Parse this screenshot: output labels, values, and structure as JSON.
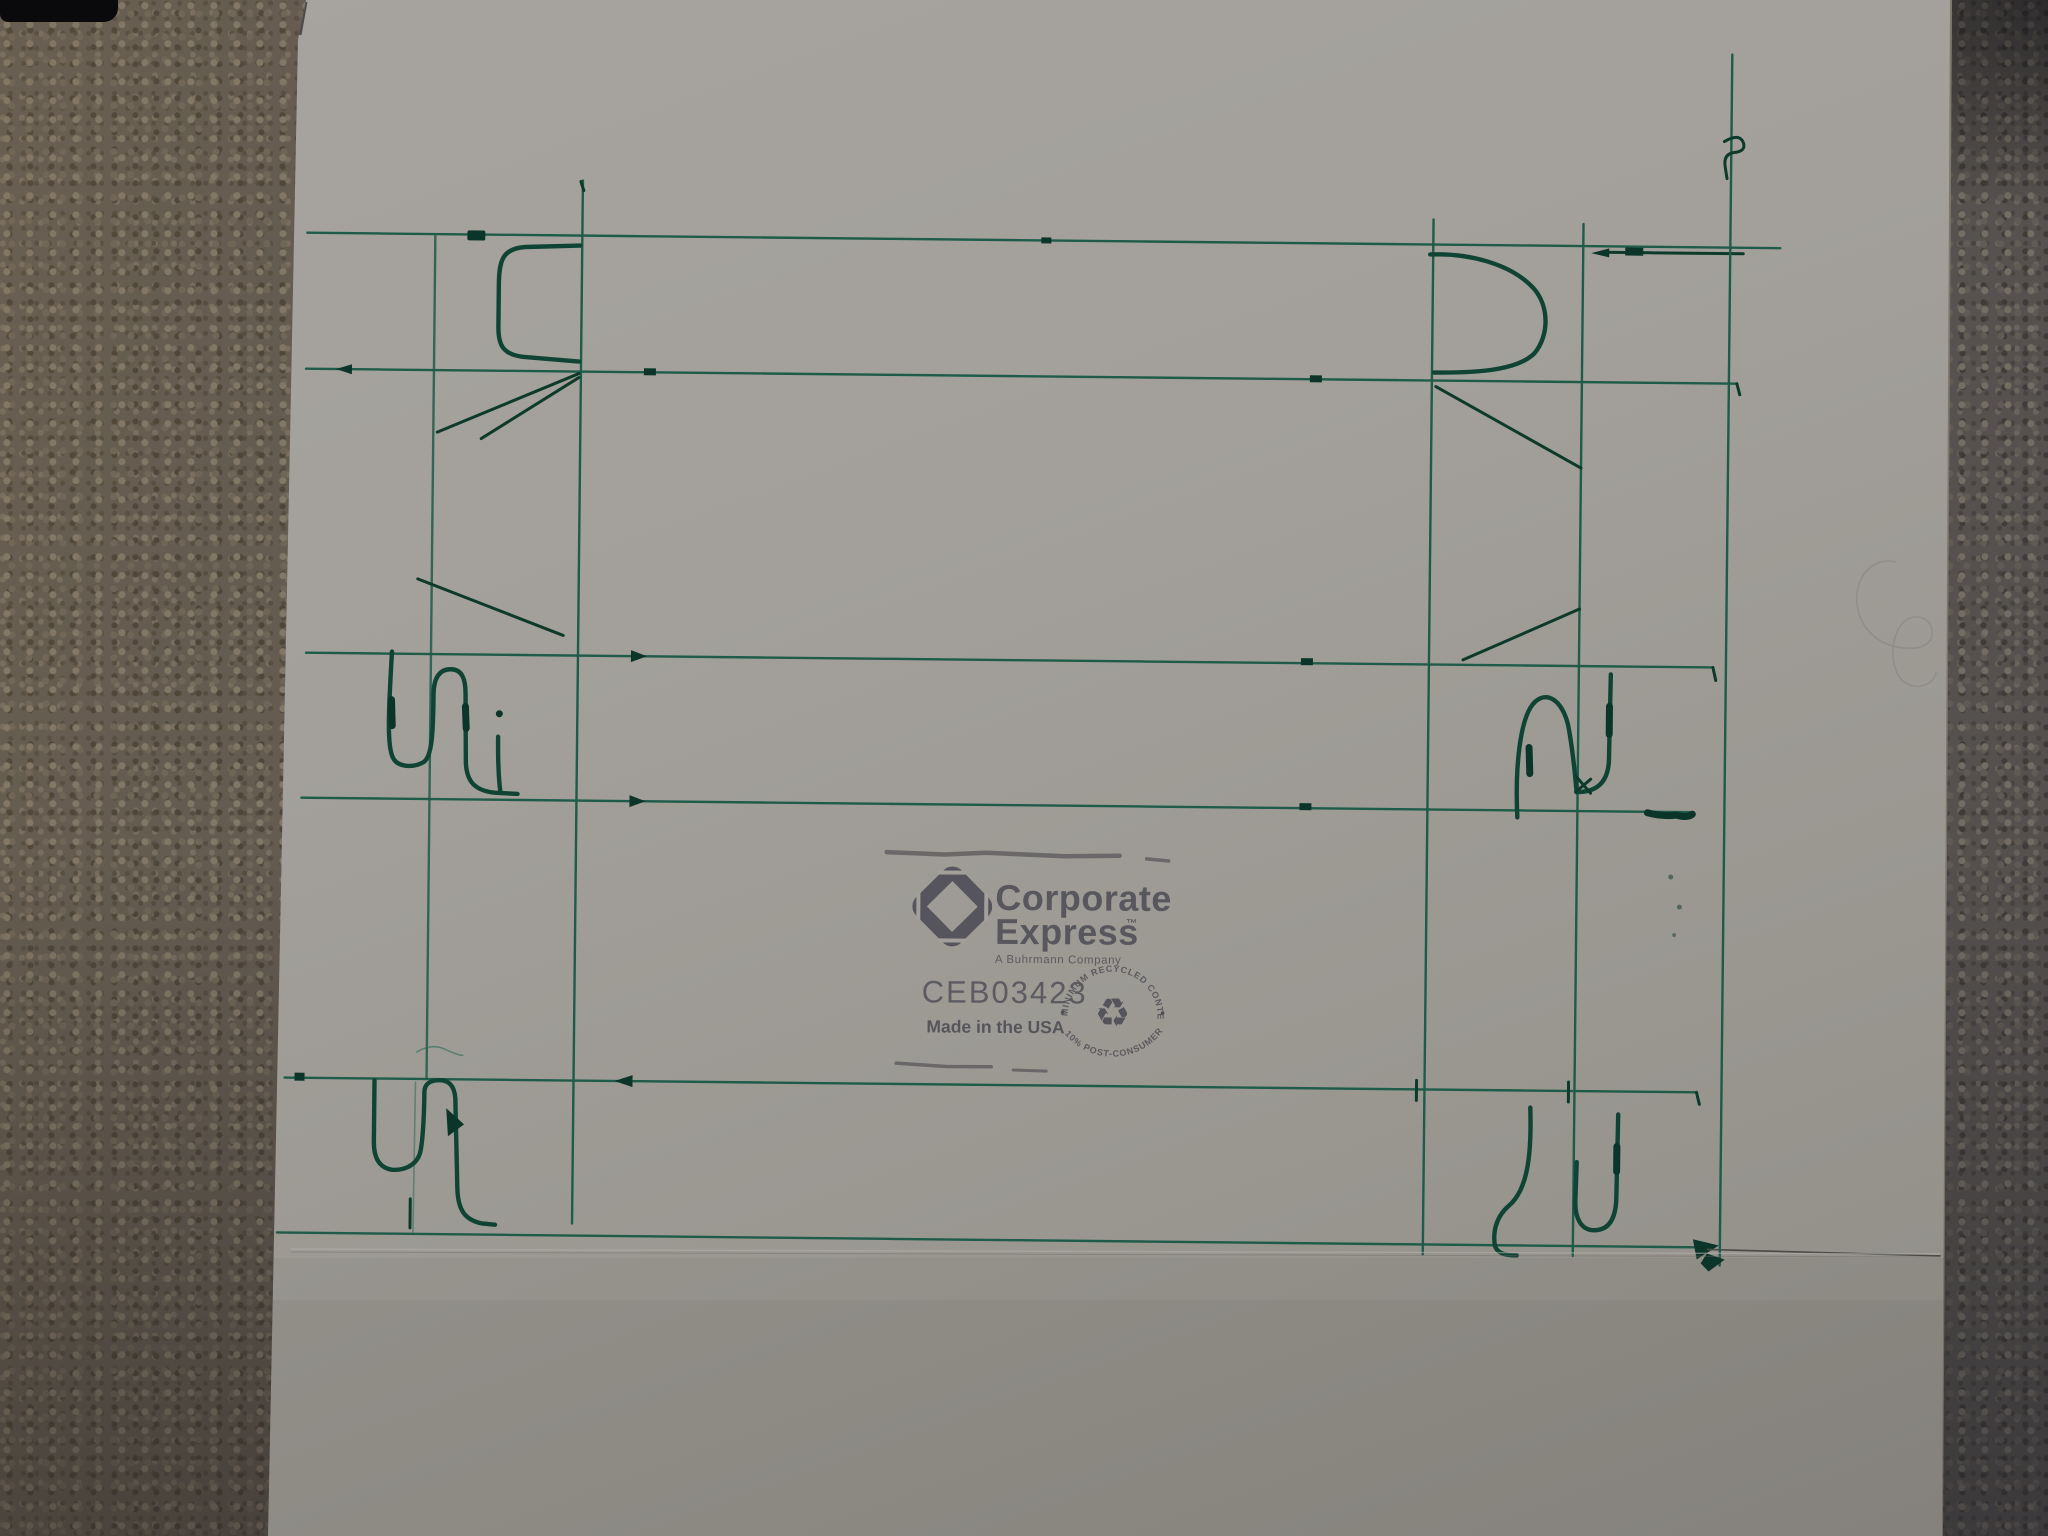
{
  "stamp": {
    "brand_line1": "Corporate",
    "brand_line2": "Express",
    "trademark": "™",
    "subtitle": "A Buhrmann Company",
    "product_code": "CEB03423",
    "origin": "Made in the USA",
    "recycle_arc_top": "MINIMUM RECYCLED CONTENT",
    "recycle_arc_bottom": "10% POST-CONSUMER",
    "recycle_symbol": "♻"
  },
  "colors": {
    "marker_green": "#1e5b49",
    "marker_green_dark": "#0f4434",
    "stamp_ink": "#4f4e56",
    "paper": "#a3a09b",
    "carpet": "#5e5850"
  }
}
